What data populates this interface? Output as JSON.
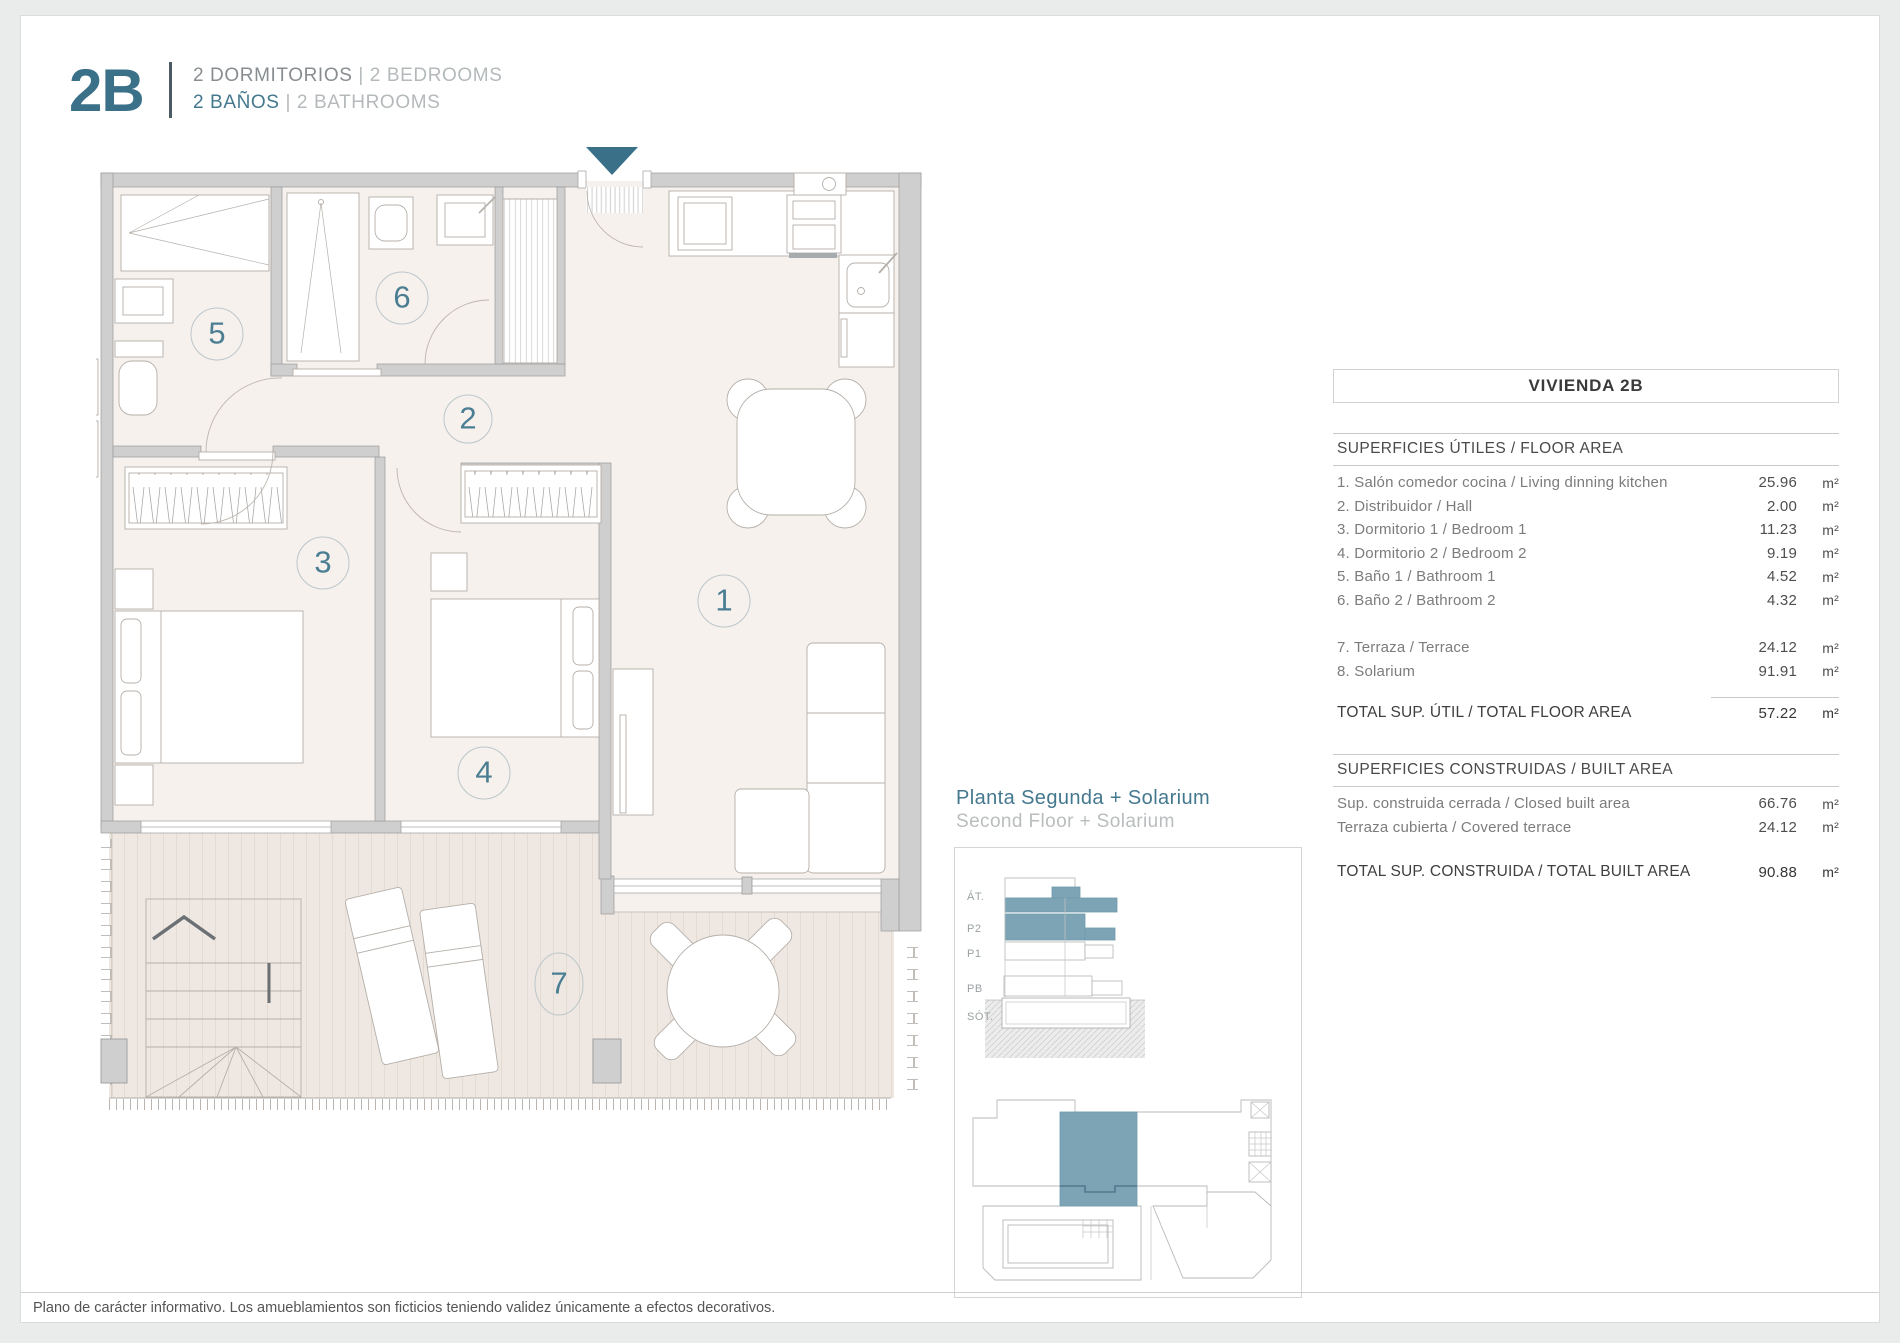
{
  "header": {
    "unit_code": "2B",
    "sep": "|",
    "bedrooms_es": "2 DORMITORIOS",
    "bedrooms_en": "2 BEDROOMS",
    "bathrooms_es": "2 BAÑOS",
    "bathrooms_en": "2 BATHROOMS"
  },
  "plan": {
    "rooms": [
      "1",
      "2",
      "3",
      "4",
      "5",
      "6",
      "7"
    ]
  },
  "legend": {
    "title_es": "Planta Segunda + Solarium",
    "title_en": "Second Floor + Solarium",
    "floors": [
      "ÁT.",
      "P2",
      "P1",
      "PB",
      "SÓT."
    ]
  },
  "table": {
    "title": "VIVIENDA 2B",
    "floor": {
      "header": "SUPERFICIES ÚTILES / FLOOR AREA",
      "rows": [
        {
          "label": "1. Salón comedor cocina / Living dinning kitchen",
          "value": "25.96",
          "unit": "m²"
        },
        {
          "label": "2. Distribuidor / Hall",
          "value": "2.00",
          "unit": "m²"
        },
        {
          "label": "3. Dormitorio 1 / Bedroom 1",
          "value": "11.23",
          "unit": "m²"
        },
        {
          "label": "4. Dormitorio 2 / Bedroom 2",
          "value": "9.19",
          "unit": "m²"
        },
        {
          "label": "5. Baño 1 / Bathroom 1",
          "value": "4.52",
          "unit": "m²"
        },
        {
          "label": "6. Baño 2 / Bathroom 2",
          "value": "4.32",
          "unit": "m²"
        }
      ],
      "rows2": [
        {
          "label": "7. Terraza / Terrace",
          "value": "24.12",
          "unit": "m²"
        },
        {
          "label": "8. Solarium",
          "value": "91.91",
          "unit": "m²"
        }
      ],
      "total": {
        "label": "TOTAL SUP. ÚTIL / TOTAL FLOOR AREA",
        "value": "57.22",
        "unit": "m²"
      }
    },
    "built": {
      "header": "SUPERFICIES CONSTRUIDAS / BUILT AREA",
      "rows": [
        {
          "label": "Sup. construida cerrada / Closed built area",
          "value": "66.76",
          "unit": "m²"
        },
        {
          "label": "Terraza cubierta / Covered terrace",
          "value": "24.12",
          "unit": "m²"
        }
      ],
      "total": {
        "label": "TOTAL SUP. CONSTRUIDA /  TOTAL BUILT AREA",
        "value": "90.88",
        "unit": "m²"
      }
    }
  },
  "footer": {
    "disclaimer": "Plano de carácter informativo. Los amueblamientos son ficticios teniendo validez únicamente a efectos decorativos."
  },
  "colors": {
    "accent_teal": "#3b7089",
    "unit_highlight": "#7da4b5",
    "number_teal": "#4b7e93",
    "wall_gray": "#cfcfcf",
    "floor_beige": "#f6f1ec",
    "deck_beige": "#efe8e2"
  }
}
